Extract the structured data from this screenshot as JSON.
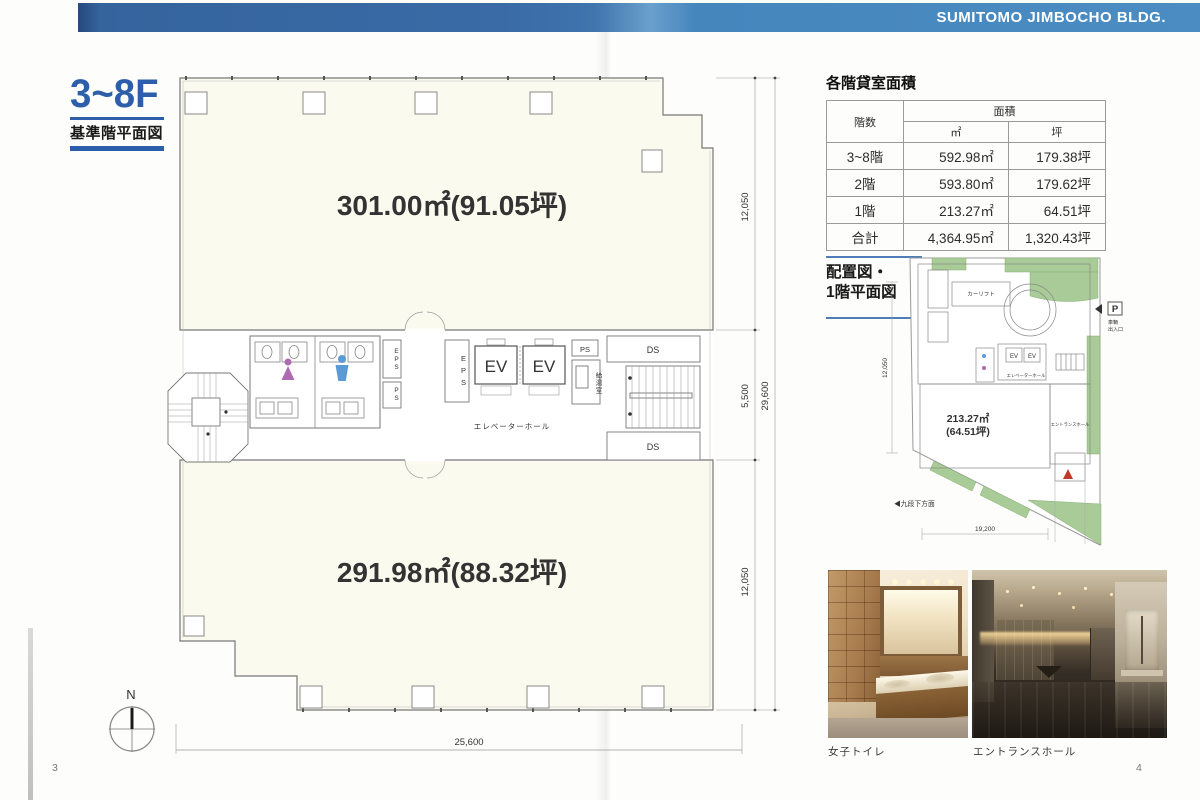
{
  "header": {
    "building_name": "SUMITOMO JIMBOCHO BLDG."
  },
  "floor_plan_page": {
    "page_number": "3",
    "title": {
      "floors": "3~8F",
      "subtitle": "基準階平面図"
    },
    "labels": {
      "upper_area": "301.00㎡(91.05坪)",
      "lower_area": "291.98㎡(88.32坪)",
      "elevator_hall": "エレベーターホール",
      "kitchenette": "給湯室",
      "ev_left": "EV",
      "ev_right": "EV",
      "eps_shaft_left": "EPS",
      "ps_shaft_left": "PS",
      "eps_shaft_center": "EPS",
      "ps_top_right": "PS",
      "duct_top": "DS",
      "duct_bottom": "DS",
      "compass_north": "N"
    },
    "dimensions": {
      "upper_depth": "12,050",
      "core_depth": "5,500",
      "lower_depth": "12,050",
      "total_depth": "29,600",
      "width": "25,600"
    }
  },
  "info_page": {
    "page_number": "4",
    "area_table": {
      "title": "各階貸室面積",
      "header": {
        "floor": "階数",
        "area": "面積",
        "sqm": "㎡",
        "tsubo": "坪"
      },
      "rows": [
        {
          "floor": "3~8階",
          "sqm": "592.98㎡",
          "tsubo": "179.38坪"
        },
        {
          "floor": "2階",
          "sqm": "593.80㎡",
          "tsubo": "179.62坪"
        },
        {
          "floor": "1階",
          "sqm": "213.27㎡",
          "tsubo": "64.51坪"
        },
        {
          "floor": "合計",
          "sqm": "4,364.95㎡",
          "tsubo": "1,320.43坪"
        }
      ]
    },
    "site_plan": {
      "title_line1": "配置図・",
      "title_line2": "1階平面図",
      "labels": {
        "car_lift": "カーリフト",
        "ev_left": "EV",
        "ev_right": "EV",
        "elevator_hall": "エレベーターホール",
        "area_sqm": "213.27㎡",
        "area_tsubo": "(64.51坪)",
        "entrance_hall": "エントランスホール",
        "parking": "P",
        "vehicle_gate_line1": "車輌",
        "vehicle_gate_line2": "出入口",
        "direction_kudanshita": "◀九段下方面"
      },
      "dimensions": {
        "left": "12,050",
        "bottom": "19,200"
      }
    },
    "photos": [
      {
        "caption": "女子トイレ"
      },
      {
        "caption": "エントランスホール"
      }
    ]
  }
}
